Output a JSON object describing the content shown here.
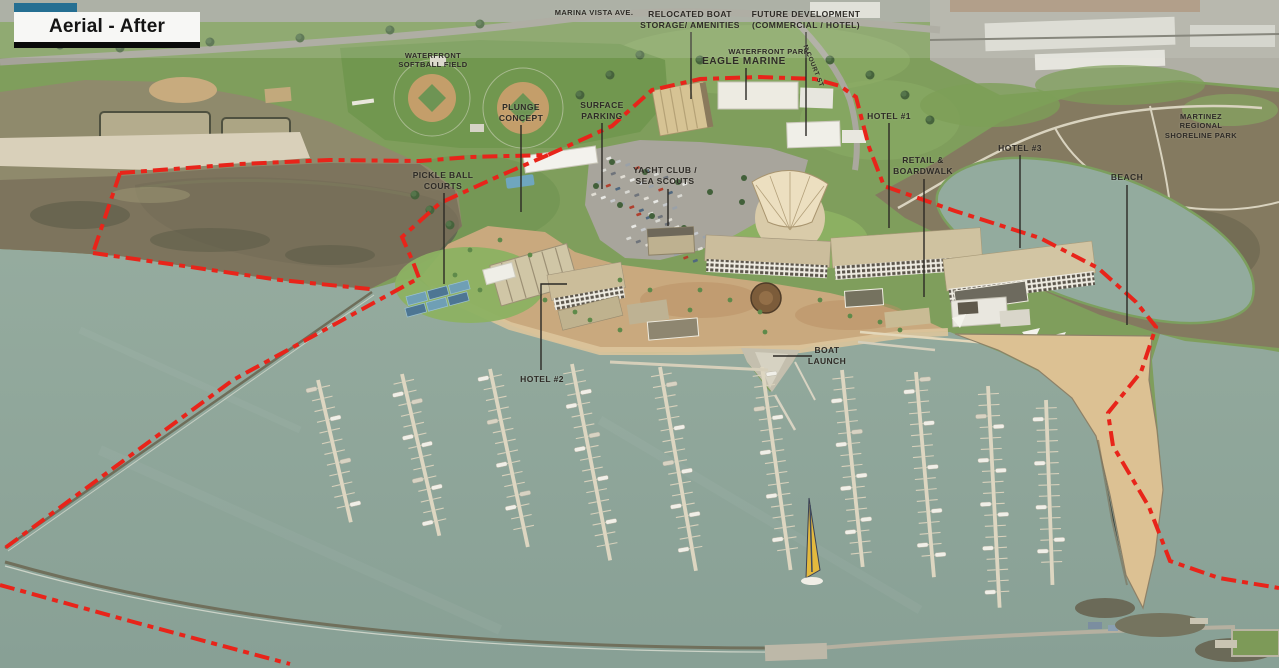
{
  "slide": {
    "title": "Aerial - After"
  },
  "colors": {
    "accent_teal": "#256f92",
    "boundary_red": "#e8241a",
    "water": "#8fa89b",
    "leader_line": "#2b2925",
    "label_text": "#2e2b26",
    "sand": "#dcc193",
    "development_ground": "#c9a97e"
  },
  "labels": {
    "marina_vista_ave": {
      "text": "MARINA VISTA AVE."
    },
    "waterfront_softball_field": {
      "text": "WATERFRONT\nSOFTBALL FIELD"
    },
    "relocated_boat_storage": {
      "text": "RELOCATED BOAT\nSTORAGE/ AMENITIES"
    },
    "future_development": {
      "text": "FUTURE DEVELOPMENT\n(COMMERCIAL / HOTEL)"
    },
    "waterfront_park": {
      "text": "WATERFRONT PARK"
    },
    "eagle_marine": {
      "text": "EAGLE MARINE"
    },
    "n_court_st": {
      "text": "N COURT ST"
    },
    "plunge_concept": {
      "text": "PLUNGE\nCONCEPT"
    },
    "surface_parking": {
      "text": "SURFACE\nPARKING"
    },
    "pickle_ball_courts": {
      "text": "PICKLE BALL\nCOURTS"
    },
    "yacht_club_sea_scouts": {
      "text": "YACHT CLUB /\nSEA SCOUTS"
    },
    "hotel_1": {
      "text": "HOTEL #1"
    },
    "hotel_2": {
      "text": "HOTEL #2"
    },
    "hotel_3": {
      "text": "HOTEL #3"
    },
    "retail_boardwalk": {
      "text": "RETAIL &\nBOARDWALK"
    },
    "beach": {
      "text": "BEACH"
    },
    "boat_launch": {
      "text": "BOAT\nLAUNCH"
    },
    "martinez_regional_shoreline_park": {
      "text": "MARTINEZ REGIONAL\nSHORELINE PARK"
    }
  },
  "scene": {
    "docks": [
      [
        318,
        380,
        146,
        -13
      ],
      [
        402,
        374,
        166,
        -13
      ],
      [
        490,
        369,
        182,
        -12
      ],
      [
        572,
        364,
        200,
        -11
      ],
      [
        660,
        367,
        207,
        -10
      ],
      [
        762,
        367,
        205,
        -8
      ],
      [
        842,
        370,
        198,
        -6
      ],
      [
        916,
        372,
        206,
        -5
      ],
      [
        988,
        386,
        222,
        -3
      ],
      [
        1046,
        400,
        185,
        -2
      ]
    ],
    "parking_blocks": [
      {
        "o": [
          606,
          158
        ],
        "cols": 9,
        "rows": 4,
        "cd": [
          9.5,
          3.2
        ],
        "rd": [
          -5,
          12
        ]
      },
      {
        "o": [
          636,
          214
        ],
        "cols": 8,
        "rows": 3,
        "cd": [
          9.5,
          3.2
        ],
        "rd": [
          -5,
          12
        ]
      }
    ],
    "car_colors": [
      "#e8e8e4",
      "#c6c9cc",
      "#9aa1a8",
      "#b0402e",
      "#50687f",
      "#d8d8d2",
      "#6f747b",
      "#e0ddd4"
    ]
  }
}
